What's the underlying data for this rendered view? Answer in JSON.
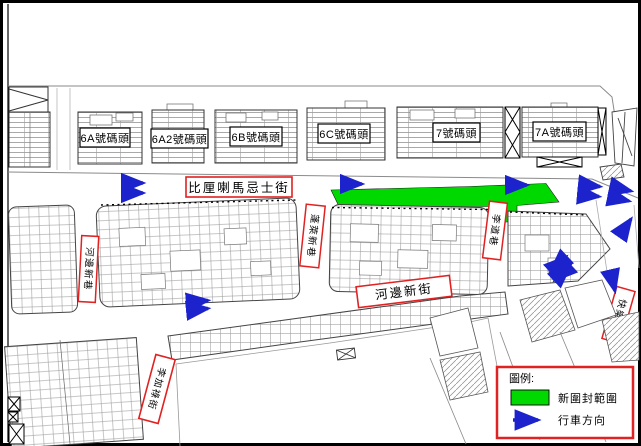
{
  "map_title": "內港碼頭區交通安排圖",
  "labels": {
    "pier_6a": "6A號碼頭",
    "pier_6a2": "6A2號碼頭",
    "pier_6b": "6B號碼頭",
    "pier_6c": "6C號碼頭",
    "pier_7": "7號碼頭",
    "pier_7a": "7A號碼頭",
    "street_main": "比厘喇馬忌士街",
    "street_riverside": "河邊新街",
    "lane_west": "河邊新巷",
    "lane_center": "蓬萊新巷",
    "lane_east": "李道巷",
    "lane_right": "快樂里",
    "street_lecaros": "李加祿街"
  },
  "legend": {
    "title": "圖例:",
    "closure_label": "新圍封範圍",
    "direction_label": "行車方向"
  },
  "colors": {
    "closure_green": "#00d900",
    "arrow_blue": "#1c23cc",
    "label_red": "#e02222",
    "outline": "#333333"
  }
}
